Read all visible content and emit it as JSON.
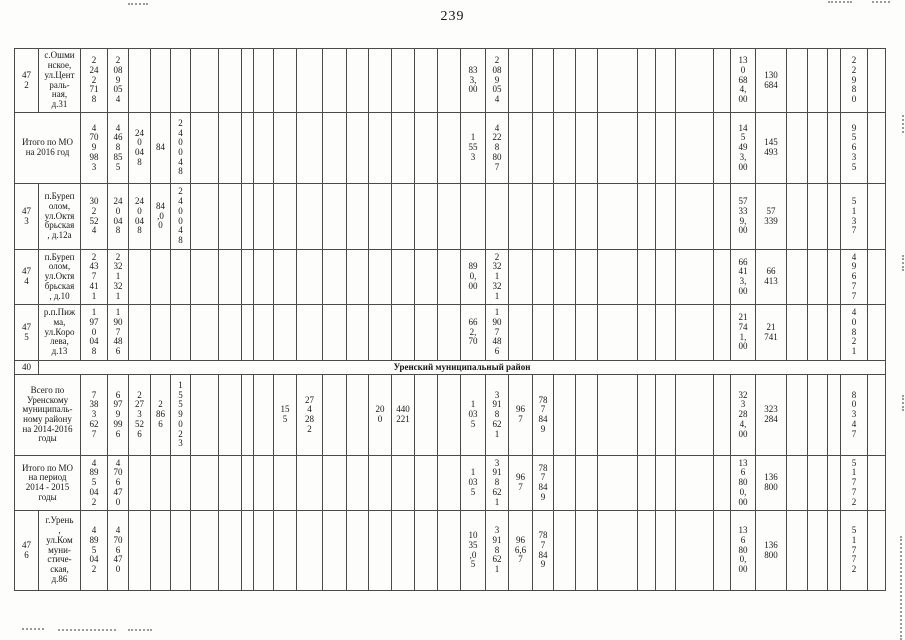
{
  "page": {
    "number": "239"
  },
  "table": {
    "columns": [
      24,
      42,
      27,
      21,
      22,
      20,
      20,
      28,
      23,
      12,
      20,
      23,
      26,
      24,
      22,
      23,
      23,
      23,
      23,
      25,
      23,
      24,
      21,
      22,
      22,
      40,
      18,
      20,
      38,
      17,
      25,
      31,
      21,
      20,
      13,
      27,
      18
    ],
    "rows": [
      {
        "name": "row-472",
        "h": 64,
        "cells": [
          {
            "c": 1,
            "t": "47\n2",
            "name": "row-number-cell"
          },
          {
            "c": 2,
            "t": "с.Ошми\nнское,\nул.Цент\nраль-\nная,\nд.31",
            "cls": "addr"
          },
          {
            "c": 3,
            "t": "2\n24\n2\n71\n8"
          },
          {
            "c": 4,
            "t": "2\n08\n9\n05\n4"
          },
          {
            "c": 20,
            "t": "83\n3,\n00"
          },
          {
            "c": 21,
            "t": "2\n08\n9\n05\n4"
          },
          {
            "c": 31,
            "t": "13\n0\n68\n4,\n00"
          },
          {
            "c": 32,
            "t": "130\n684"
          },
          {
            "c": 36,
            "t": "2\n2\n9\n8\n0"
          }
        ]
      },
      {
        "name": "row-total-mo-2016",
        "h": 71,
        "cells": [
          {
            "c": 1,
            "cs": 2,
            "t": "Итого по МО\nна 2016 год",
            "cls": "label"
          },
          {
            "c": 3,
            "t": "4\n70\n9\n98\n3"
          },
          {
            "c": 4,
            "t": "4\n46\n8\n85\n5"
          },
          {
            "c": 5,
            "t": "24\n0\n04\n8"
          },
          {
            "c": 6,
            "t": "84"
          },
          {
            "c": 7,
            "t": "2\n4\n0\n0\n4\n8"
          },
          {
            "c": 20,
            "t": "1\n55\n3"
          },
          {
            "c": 21,
            "t": "4\n22\n8\n80\n7"
          },
          {
            "c": 31,
            "t": "14\n5\n49\n3,\n00"
          },
          {
            "c": 32,
            "t": "145\n493"
          },
          {
            "c": 36,
            "t": "9\n5\n6\n3\n5"
          }
        ]
      },
      {
        "name": "row-473",
        "h": 66,
        "cells": [
          {
            "c": 1,
            "t": "47\n3",
            "name": "row-number-cell"
          },
          {
            "c": 2,
            "t": "п.Буреп\nолом,\nул.Октя\nбрьская\n, д.12а",
            "cls": "addr"
          },
          {
            "c": 3,
            "t": "30\n2\n52\n4"
          },
          {
            "c": 4,
            "t": "24\n0\n04\n8"
          },
          {
            "c": 5,
            "t": "24\n0\n04\n8"
          },
          {
            "c": 6,
            "t": "84\n,0\n0"
          },
          {
            "c": 7,
            "t": "2\n4\n0\n0\n4\n8"
          },
          {
            "c": 31,
            "t": "57\n33\n9,\n00"
          },
          {
            "c": 32,
            "t": "57\n339"
          },
          {
            "c": 36,
            "t": "5\n1\n3\n7"
          }
        ]
      },
      {
        "name": "row-474",
        "h": 55,
        "cells": [
          {
            "c": 1,
            "t": "47\n4",
            "name": "row-number-cell"
          },
          {
            "c": 2,
            "t": "п.Буреп\nолом,\nул.Октя\nбрьская\n, д.10",
            "cls": "addr"
          },
          {
            "c": 3,
            "t": "2\n43\n7\n41\n1"
          },
          {
            "c": 4,
            "t": "2\n32\n1\n32\n1"
          },
          {
            "c": 20,
            "t": "89\n0,\n00"
          },
          {
            "c": 21,
            "t": "2\n32\n1\n32\n1"
          },
          {
            "c": 31,
            "t": "66\n41\n3,\n00"
          },
          {
            "c": 32,
            "t": "66\n413"
          },
          {
            "c": 36,
            "t": "4\n9\n6\n7\n7"
          }
        ]
      },
      {
        "name": "row-475",
        "h": 56,
        "cells": [
          {
            "c": 1,
            "t": "47\n5",
            "name": "row-number-cell"
          },
          {
            "c": 2,
            "t": "р.п.Пиж\nма,\nул.Коро\nлева,\nд.13",
            "cls": "addr"
          },
          {
            "c": 3,
            "t": "1\n97\n0\n04\n8"
          },
          {
            "c": 4,
            "t": "1\n90\n7\n48\n6"
          },
          {
            "c": 20,
            "t": "66\n2,\n70"
          },
          {
            "c": 21,
            "t": "1\n90\n7\n48\n6"
          },
          {
            "c": 31,
            "t": "21\n74\n1,\n00"
          },
          {
            "c": 32,
            "t": "21\n741"
          },
          {
            "c": 36,
            "t": "4\n0\n8\n2\n1"
          }
        ]
      },
      {
        "name": "row-40-section",
        "h": 14,
        "cells": [
          {
            "c": 1,
            "t": "40",
            "cls": "label",
            "name": "row-number-cell"
          },
          {
            "c": 2,
            "cs": 36,
            "t": "Уренский муниципальный район",
            "cls": "section",
            "name": "section-title-cell"
          }
        ]
      },
      {
        "name": "row-total-urensky-district",
        "h": 81,
        "cells": [
          {
            "c": 1,
            "cs": 2,
            "t": "Всего по\nУренскому\nмуниципаль-\nному району\nна 2014-2016\nгоды",
            "cls": "label"
          },
          {
            "c": 3,
            "t": "7\n38\n3\n62\n7"
          },
          {
            "c": 4,
            "t": "6\n97\n9\n99\n6"
          },
          {
            "c": 5,
            "t": "2\n27\n3\n52\n6"
          },
          {
            "c": 6,
            "t": "2\n86\n6"
          },
          {
            "c": 7,
            "t": "1\n5\n5\n9\n0\n2\n3"
          },
          {
            "c": 12,
            "t": "15\n5"
          },
          {
            "c": 13,
            "t": "27\n4\n28\n2"
          },
          {
            "c": 16,
            "t": "20\n0"
          },
          {
            "c": 17,
            "t": "440\n221"
          },
          {
            "c": 20,
            "t": "1\n03\n5"
          },
          {
            "c": 21,
            "t": "3\n91\n8\n62\n1"
          },
          {
            "c": 22,
            "t": "96\n7"
          },
          {
            "c": 23,
            "t": "78\n7\n84\n9"
          },
          {
            "c": 31,
            "t": "32\n3\n28\n4,\n00"
          },
          {
            "c": 32,
            "t": "323\n284"
          },
          {
            "c": 36,
            "t": "8\n0\n3\n4\n7"
          }
        ]
      },
      {
        "name": "row-total-mo-2014-2015",
        "h": 55,
        "cells": [
          {
            "c": 1,
            "cs": 2,
            "t": "Итого по МО\nна период\n2014 - 2015\nгоды",
            "cls": "label"
          },
          {
            "c": 3,
            "t": "4\n89\n5\n04\n2"
          },
          {
            "c": 4,
            "t": "4\n70\n6\n47\n0"
          },
          {
            "c": 20,
            "t": "1\n03\n5"
          },
          {
            "c": 21,
            "t": "3\n91\n8\n62\n1"
          },
          {
            "c": 22,
            "t": "96\n7"
          },
          {
            "c": 23,
            "t": "78\n7\n84\n9"
          },
          {
            "c": 31,
            "t": "13\n6\n80\n0,\n00"
          },
          {
            "c": 32,
            "t": "136\n800"
          },
          {
            "c": 36,
            "t": "5\n1\n7\n7\n2"
          }
        ]
      },
      {
        "name": "row-476",
        "h": 80,
        "cells": [
          {
            "c": 1,
            "t": "47\n6",
            "name": "row-number-cell"
          },
          {
            "c": 2,
            "t": "г.Урень\n,\nул.Ком\nмуни-\nстиче-\nская,\nд.86",
            "cls": "addr"
          },
          {
            "c": 3,
            "t": "4\n89\n5\n04\n2"
          },
          {
            "c": 4,
            "t": "4\n70\n6\n47\n0"
          },
          {
            "c": 20,
            "t": "10\n35\n,0\n5"
          },
          {
            "c": 21,
            "t": "3\n91\n8\n62\n1"
          },
          {
            "c": 22,
            "t": "96\n6,6\n7"
          },
          {
            "c": 23,
            "t": "78\n7\n84\n9"
          },
          {
            "c": 31,
            "t": "13\n6\n80\n0,\n00"
          },
          {
            "c": 32,
            "t": "136\n800"
          },
          {
            "c": 36,
            "t": "5\n1\n7\n7\n2"
          }
        ]
      }
    ]
  }
}
